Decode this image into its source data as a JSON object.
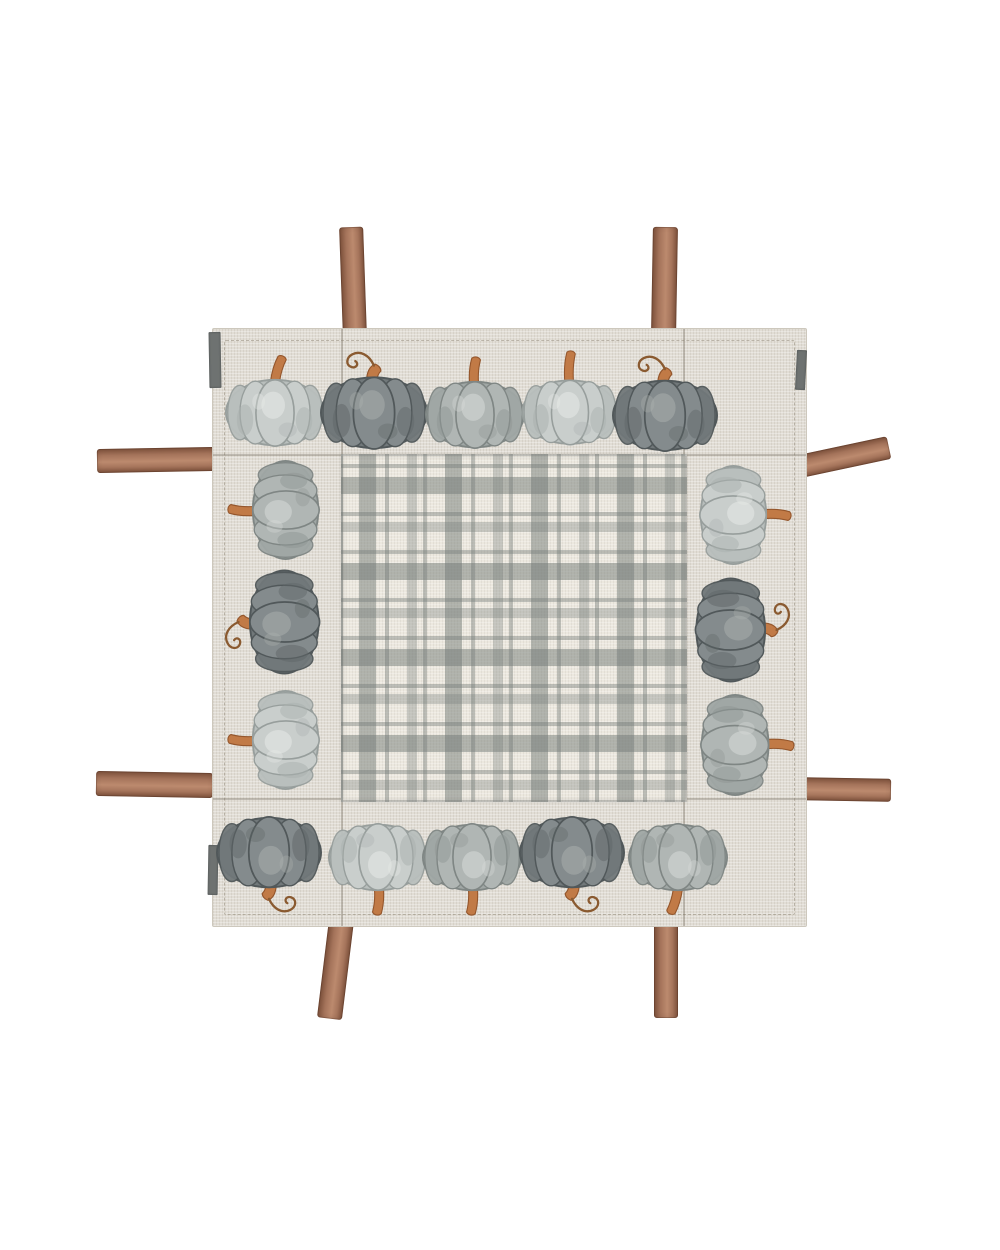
{
  "image": {
    "alt": "Square fall table topper: natural linen border printed with watercolor gray pumpkins, gray windowpane-plaid center panel, brown suede ribbon ties at the edges, on a white background",
    "background_color": "#ffffff"
  },
  "cloth": {
    "x": 212,
    "y": 328,
    "width": 593,
    "height": 597,
    "linen_color": "#e1ddd5",
    "edge_color": "#cdc8bd",
    "hem_inset": 11,
    "seams": {
      "v": [
        128,
        470
      ],
      "h": [
        125,
        469
      ]
    },
    "backing_color": "#6e7271",
    "backing_slivers": [
      {
        "x": 209,
        "y": 332,
        "w": 12,
        "h": 56,
        "rot": -1
      },
      {
        "x": 208,
        "y": 845,
        "w": 10,
        "h": 50,
        "rot": 1
      },
      {
        "x": 796,
        "y": 350,
        "w": 10,
        "h": 40,
        "rot": 3
      }
    ]
  },
  "plaid": {
    "x": 128,
    "y": 125,
    "width": 342,
    "height": 344,
    "bg": "#ece8df",
    "stripe_rgb": "116,123,120",
    "unit": 86,
    "offset_x": 16,
    "offset_y": 38,
    "stripes": [
      {
        "start": 0,
        "end": 17,
        "alpha": 0.5
      },
      {
        "start": 26,
        "end": 30,
        "alpha": 0.42
      },
      {
        "start": 48,
        "end": 58,
        "alpha": 0.33
      },
      {
        "start": 64,
        "end": 68,
        "alpha": 0.42
      }
    ]
  },
  "pumpkins": {
    "box": {
      "w": 112,
      "h": 100
    },
    "variants": {
      "light": {
        "lobe": "#c9cecc",
        "side": "#b9bfbd",
        "edge": "#979e9c",
        "hi": "#e9ece9",
        "shade": "#a9b0ae"
      },
      "medium": {
        "lobe": "#b0b6b4",
        "side": "#a0a7a5",
        "edge": "#7f8684",
        "hi": "#d9dddb",
        "shade": "#8e9593"
      },
      "dark": {
        "lobe": "#848b8d",
        "side": "#71787a",
        "edge": "#51585a",
        "hi": "#abb1af",
        "shade": "#5f6668"
      }
    },
    "stem_colors": {
      "fill": "#c17a46",
      "dark": "#94562c",
      "tendril": "#8a5a30"
    },
    "items": [
      {
        "x": 275,
        "y": 412,
        "rot": 0,
        "variant": "light",
        "stem": "tilted",
        "scale": 1.0
      },
      {
        "x": 374,
        "y": 411,
        "rot": 0,
        "variant": "dark",
        "stem": "curly",
        "scale": 1.08
      },
      {
        "x": 475,
        "y": 414,
        "rot": 0,
        "variant": "medium",
        "stem": "straight",
        "scale": 1.0
      },
      {
        "x": 570,
        "y": 412,
        "rot": 0,
        "variant": "light",
        "stem": "tall",
        "scale": 0.97
      },
      {
        "x": 665,
        "y": 414,
        "rot": 0,
        "variant": "dark",
        "stem": "curly",
        "scale": 1.06
      },
      {
        "x": 285,
        "y": 510,
        "rot": -90,
        "variant": "medium",
        "stem": "straight",
        "scale": 1.0
      },
      {
        "x": 283,
        "y": 622,
        "rot": -90,
        "variant": "dark",
        "stem": "curly",
        "scale": 1.05
      },
      {
        "x": 285,
        "y": 740,
        "rot": -90,
        "variant": "light",
        "stem": "straight",
        "scale": 1.0
      },
      {
        "x": 733,
        "y": 515,
        "rot": 90,
        "variant": "light",
        "stem": "straight",
        "scale": 1.0
      },
      {
        "x": 731,
        "y": 630,
        "rot": 90,
        "variant": "dark",
        "stem": "curly",
        "scale": 1.05
      },
      {
        "x": 735,
        "y": 745,
        "rot": 90,
        "variant": "medium",
        "stem": "straight",
        "scale": 1.02
      },
      {
        "x": 269,
        "y": 853,
        "rot": 180,
        "variant": "dark",
        "stem": "curly",
        "scale": 1.06
      },
      {
        "x": 378,
        "y": 857,
        "rot": 180,
        "variant": "light",
        "stem": "straight",
        "scale": 1.0
      },
      {
        "x": 472,
        "y": 857,
        "rot": 180,
        "variant": "medium",
        "stem": "straight",
        "scale": 1.0
      },
      {
        "x": 572,
        "y": 853,
        "rot": 180,
        "variant": "dark",
        "stem": "curly",
        "scale": 1.06
      },
      {
        "x": 678,
        "y": 857,
        "rot": 180,
        "variant": "medium",
        "stem": "tilted",
        "scale": 1.0
      }
    ]
  },
  "ties": {
    "color_mid": "#a5745b",
    "color_edge": "#7e523c",
    "color_hi": "#bc8a6e",
    "items": [
      {
        "name": "top-left",
        "x": 341,
        "y": 227,
        "w": 24,
        "h": 108,
        "rot": -2
      },
      {
        "name": "top-right",
        "x": 652,
        "y": 227,
        "w": 25,
        "h": 107,
        "rot": 1
      },
      {
        "name": "left-top",
        "x": 97,
        "y": 448,
        "w": 118,
        "h": 24,
        "rot": -1
      },
      {
        "name": "left-bottom",
        "x": 96,
        "y": 772,
        "w": 117,
        "h": 25,
        "rot": 1
      },
      {
        "name": "right-top",
        "x": 794,
        "y": 446,
        "w": 96,
        "h": 23,
        "rot": -12
      },
      {
        "name": "right-bottom",
        "x": 800,
        "y": 778,
        "w": 91,
        "h": 23,
        "rot": 1
      },
      {
        "name": "bottom-left",
        "x": 323,
        "y": 919,
        "w": 25,
        "h": 100,
        "rot": 7
      },
      {
        "name": "bottom-right",
        "x": 654,
        "y": 920,
        "w": 24,
        "h": 98,
        "rot": 0
      }
    ]
  }
}
